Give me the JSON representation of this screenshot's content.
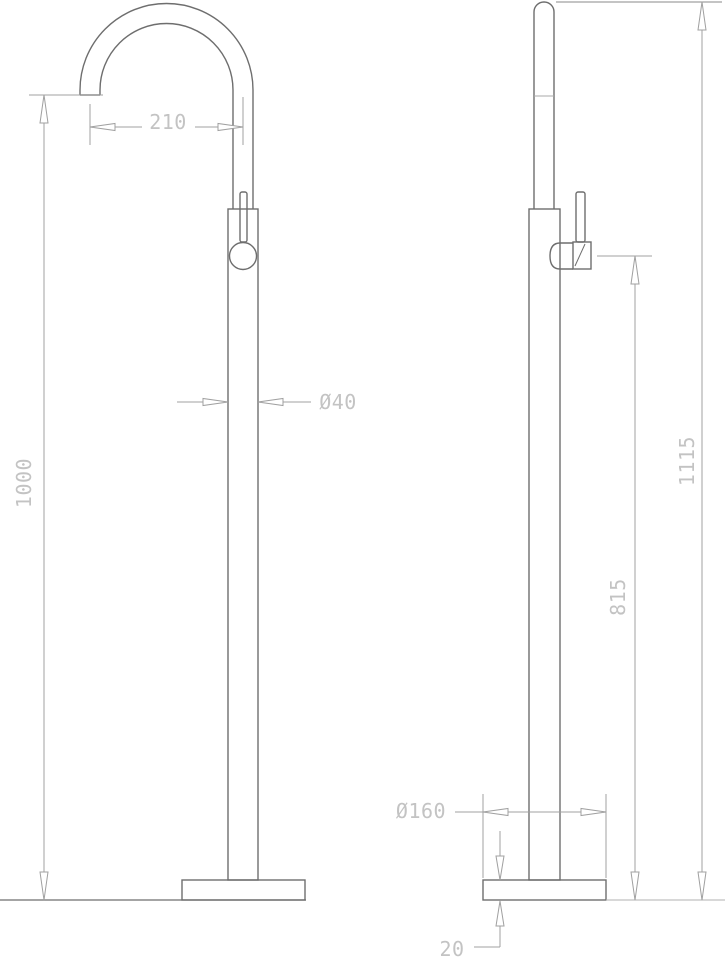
{
  "drawing": {
    "type": "technical-dimension-drawing",
    "subject": "freestanding-faucet-two-views",
    "dimensions": {
      "spout_reach": "210",
      "column_diameter": "Ø40",
      "spout_height": "1000",
      "total_height": "1115",
      "handle_height": "815",
      "base_diameter": "Ø160",
      "base_thickness": "20"
    },
    "colors": {
      "object_line": "#6e6e6e",
      "dimension_line": "#a0a0a0",
      "label_text": "#c3c3c3",
      "background": "#ffffff"
    }
  }
}
